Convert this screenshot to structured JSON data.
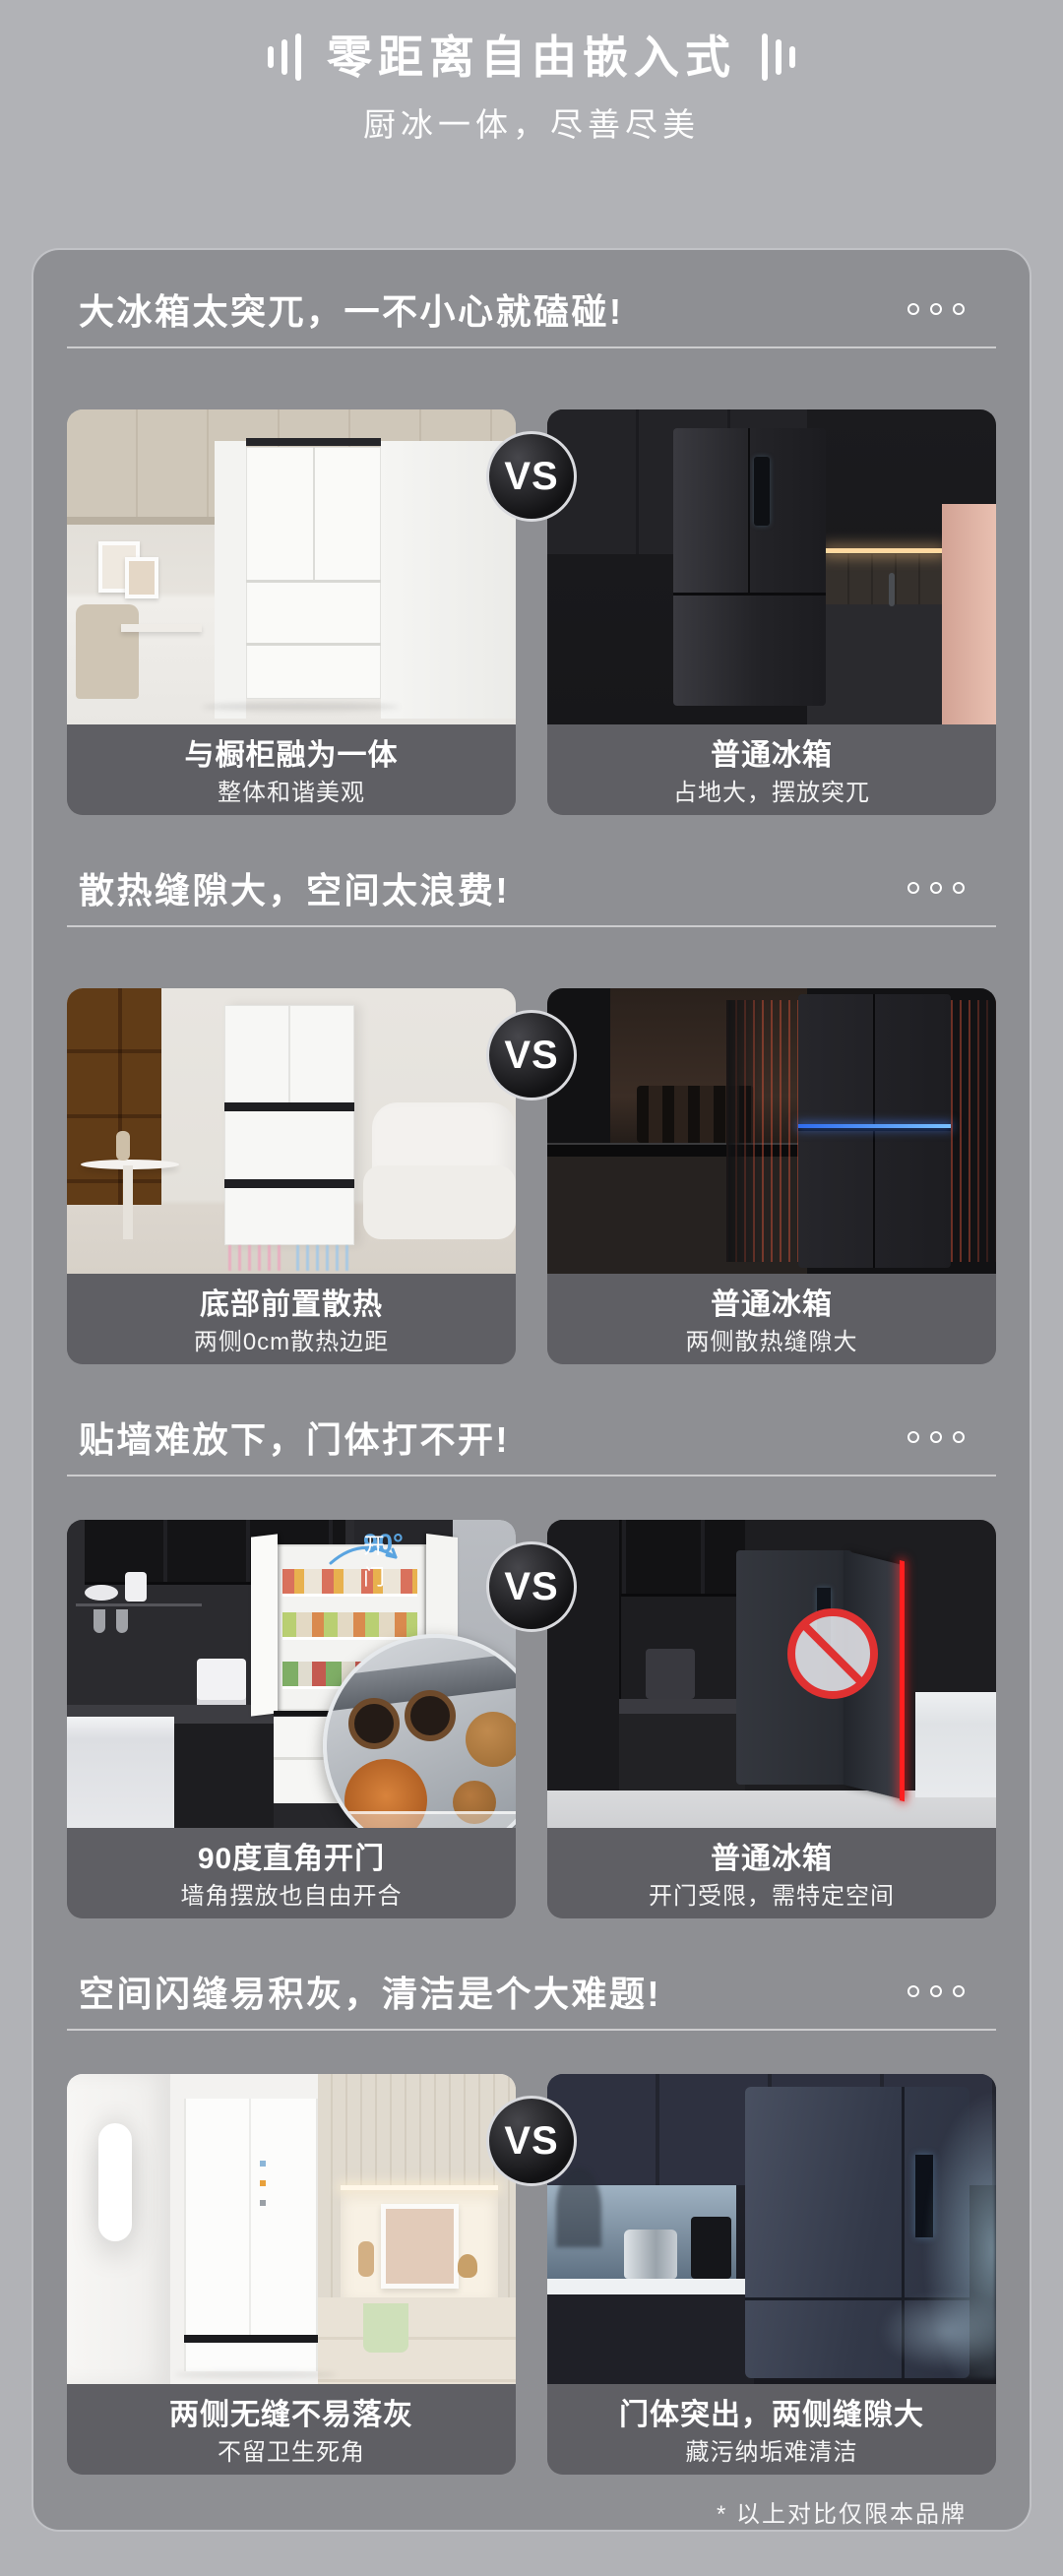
{
  "header": {
    "title": "零距离自由嵌入式",
    "subtitle": "厨冰一体，尽善尽美"
  },
  "vs_label": "VS",
  "footer_note": "* 以上对比仅限本品牌",
  "sections": [
    {
      "heading": "大冰箱太突兀，一不小心就磕碰!",
      "left": {
        "caption_title": "与橱柜融为一体",
        "caption_subtitle": "整体和谐美观"
      },
      "right": {
        "caption_title": "普通冰箱",
        "caption_subtitle": "占地大，摆放突兀"
      }
    },
    {
      "heading": "散热缝隙大，空间太浪费!",
      "left": {
        "caption_title": "底部前置散热",
        "caption_subtitle": "两侧0cm散热边距"
      },
      "right": {
        "caption_title": "普通冰箱",
        "caption_subtitle": "两侧散热缝隙大"
      }
    },
    {
      "heading": "贴墙难放下，门体打不开!",
      "left": {
        "caption_title": "90度直角开门",
        "caption_subtitle": "墙角摆放也自由开合",
        "overlay_badge_value": "90°",
        "overlay_badge_label": "开门"
      },
      "right": {
        "caption_title": "普通冰箱",
        "caption_subtitle": "开门受限，需特定空间"
      }
    },
    {
      "heading": "空间闪缝易积灰，清洁是个大难题!",
      "left": {
        "caption_title": "两侧无缝不易落灰",
        "caption_subtitle": "不留卫生死角"
      },
      "right": {
        "caption_title": "门体突出，两侧缝隙大",
        "caption_subtitle": "藏污纳垢难清洁"
      }
    }
  ],
  "colors": {
    "page_bg": "#b1b2b6",
    "card_bg": "#8e8f93",
    "caption_bg": "#5f5f64",
    "accent_blue": "#5aa4e0",
    "warning_red": "#ff1f1f",
    "led_blue": "#79c1ff"
  }
}
